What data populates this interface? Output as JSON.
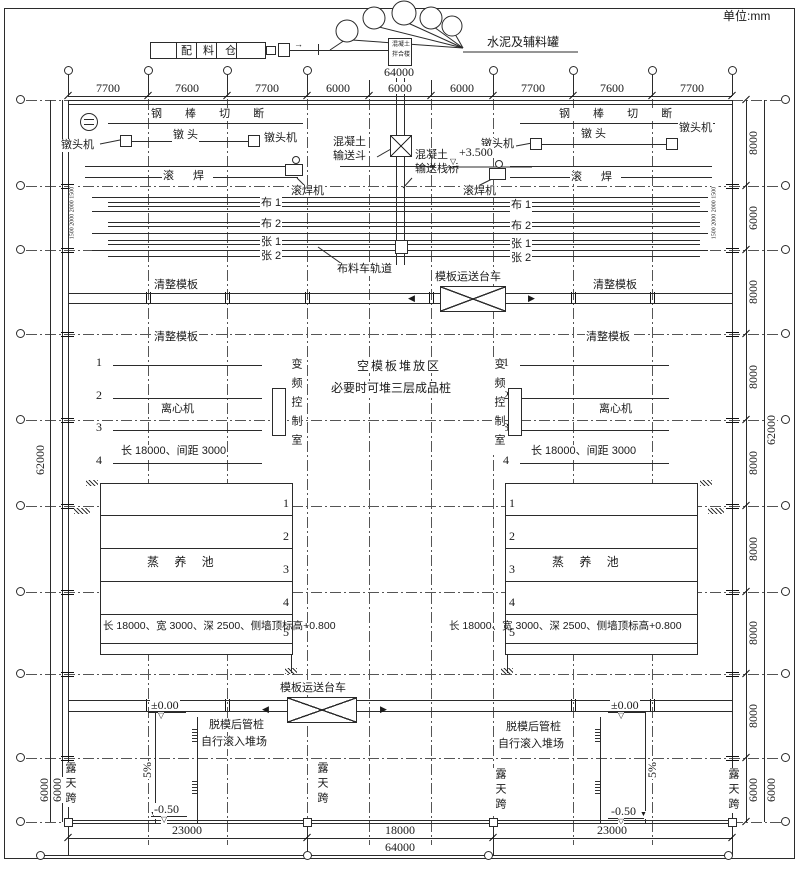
{
  "units_label": "单位:mm",
  "grid": {
    "top_dims": [
      "7700",
      "7600",
      "7700",
      "6000",
      "6000",
      "6000",
      "7700",
      "7600",
      "7700"
    ],
    "top_overall": "64000",
    "right_dims": [
      "8000",
      "6000",
      "8000",
      "8000",
      "8000",
      "8000",
      "8000",
      "8000"
    ],
    "right_bottom_dim_inner": "6000",
    "right_bottom_dim_outer": "6000",
    "right_overall": "62000",
    "left_overall": "62000",
    "left_bottom_dim_inner": "6000",
    "left_bottom_dim_outer": "6000",
    "bottom_dims": [
      "23000",
      "18000",
      "23000"
    ],
    "bottom_overall": "64000",
    "bed_edge_dims": "1500 2000 2000 1500"
  },
  "top_area": {
    "batching_silo": "配 料 仓",
    "tanks_label": "水泥及辅料罐",
    "mixing_tower_l1": "混凝土",
    "mixing_tower_l2": "拌合楼",
    "arrow_right": "→"
  },
  "line1": {
    "steel_cut": "钢 棒 切 断",
    "heading_machine": "镦头机",
    "heading": "镦 头",
    "roll_weld": "滚  焊",
    "roll_weld_machine": "滚焊机"
  },
  "beds": {
    "bu1": "布 1",
    "bu2": "布 2",
    "zhang1": "张 1",
    "zhang2": "张 2"
  },
  "convey": {
    "hopper_l1": "混凝土",
    "hopper_l2": "输送斗",
    "bridge_l1": "混凝土",
    "bridge_l2": "输送栈桥",
    "bridge_elev": "+3.500",
    "cart_track": "布料车轨道"
  },
  "mid": {
    "clean_formwork": "清整模板",
    "trolley": "模板运送台车",
    "stack_l1": "空模板堆放区",
    "stack_l2": "必要时可堆三层成品桩",
    "vfd_room": "变频控制室",
    "centrifuge": "离心机",
    "centrifuge_note": "长 18000、间距 3000",
    "n1": "1",
    "n2": "2",
    "n3": "3",
    "n4": "4"
  },
  "pool": {
    "name": "蒸 养 池",
    "note": "长 18000、宽 3000、深 2500、侧墙顶标高+0.800",
    "n1": "1",
    "n2": "2",
    "n3": "3",
    "n4": "4",
    "n5": "5"
  },
  "bottom": {
    "trolley": "模板运送台车",
    "demold_l1": "脱模后管桩",
    "demold_l2": "自行滚入堆场",
    "slope": "5%",
    "elev_zero": "±0.00",
    "elev_neg": "-0.50",
    "open_span": "露天跨"
  },
  "symbols": {
    "tri_down": "▽",
    "arrow_left": "◀",
    "arrow_right": "▶",
    "arrow_down": "▼"
  }
}
